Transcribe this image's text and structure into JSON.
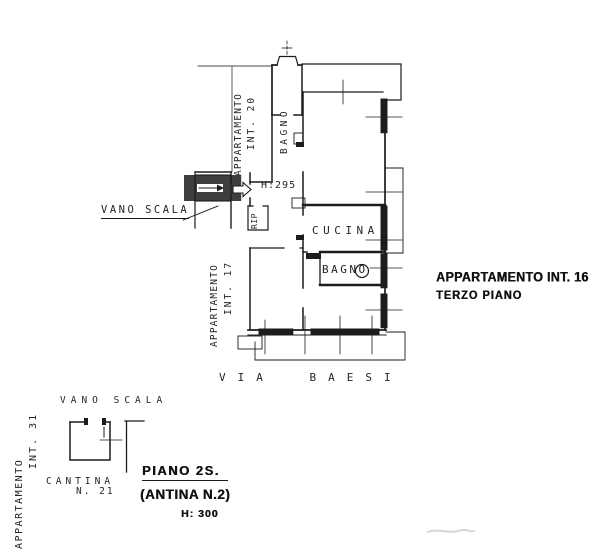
{
  "colors": {
    "ink": "#1c1c1c",
    "thin_line": "#4a4a4a",
    "paper": "#ffffff",
    "smudge": "#c6c6c6"
  },
  "main_plan": {
    "apartment_20": {
      "line1": "APPARTAMENTO",
      "line2": "INT. 20"
    },
    "apartment_17": {
      "line1": "APPARTAMENTO",
      "line2": "INT. 17"
    },
    "stairwell_label": "VANO SCALA",
    "ceiling_height": "H:295",
    "closet": "RIP",
    "bathroom_top": "BAGNO",
    "kitchen": "CUCINA",
    "bathroom_main": "BAGNO",
    "street": "VIA BAESI",
    "title_line1": "APPARTAMENTO INT. 16",
    "title_line2": "TERZO PIANO"
  },
  "basement_plan": {
    "stairwell_label": "VANO SCALA",
    "apartment_31": {
      "line1": "APPARTAMENTO",
      "line2": "INT. 31"
    },
    "cellar_line1": "CANTINA",
    "cellar_line2": "N. 21",
    "caption_floor": "PIANO 2S.",
    "caption_cellar": "(ANTINA N.2)",
    "caption_height": "H: 300"
  }
}
